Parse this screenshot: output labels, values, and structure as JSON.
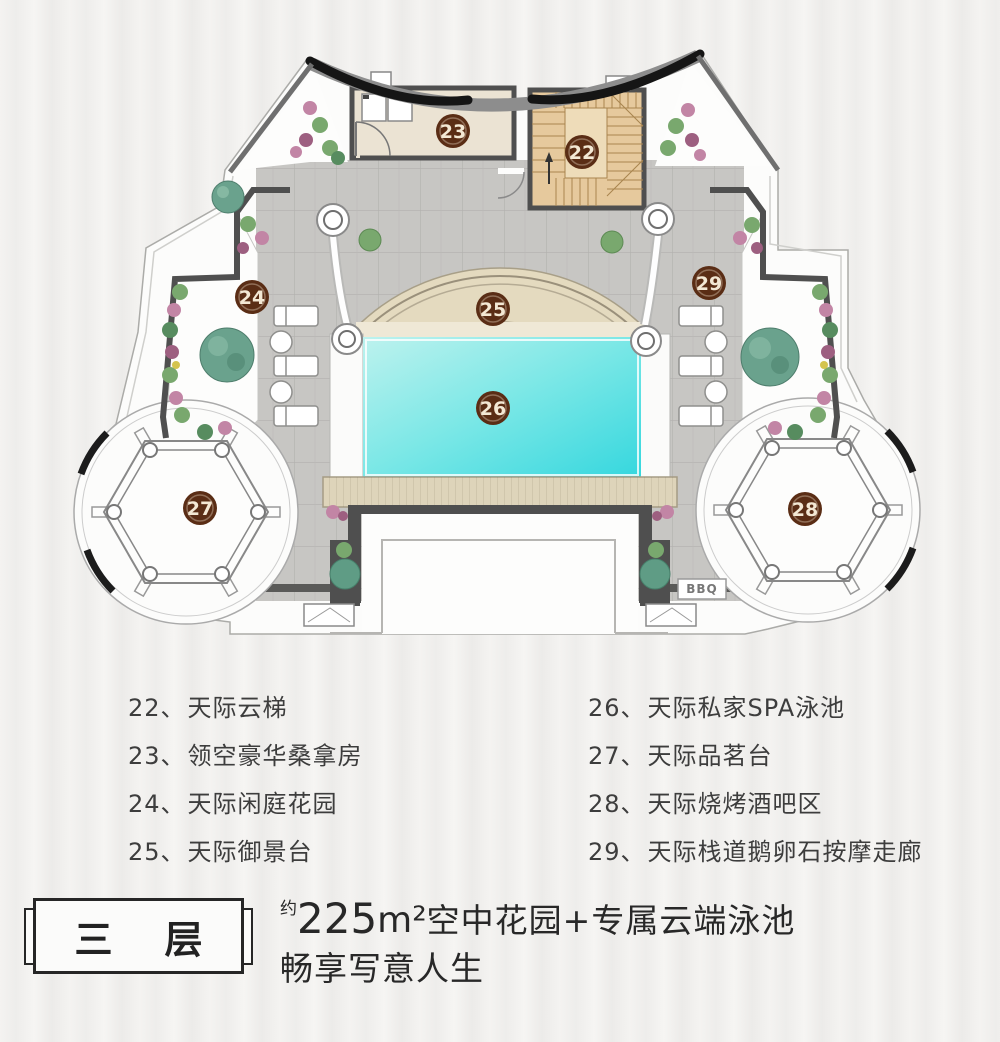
{
  "plan": {
    "markers": [
      {
        "label": "22"
      },
      {
        "label": "23"
      },
      {
        "label": "24"
      },
      {
        "label": "25"
      },
      {
        "label": "26"
      },
      {
        "label": "27"
      },
      {
        "label": "28"
      },
      {
        "label": "29"
      }
    ],
    "bbq": "BBQ"
  },
  "legend": {
    "left": [
      {
        "num": "22、",
        "name": "天际云梯"
      },
      {
        "num": "23、",
        "name": "领空豪华桑拿房"
      },
      {
        "num": "24、",
        "name": "天际闲庭花园"
      },
      {
        "num": "25、",
        "name": "天际御景台"
      }
    ],
    "right": [
      {
        "num": "26、",
        "name": "天际私家SPA泳池"
      },
      {
        "num": "27、",
        "name": "天际品茗台"
      },
      {
        "num": "28、",
        "name": "天际烧烤酒吧区"
      },
      {
        "num": "29、",
        "name": "天际栈道鹅卵石按摩走廊"
      }
    ]
  },
  "footer": {
    "floor_label_1": "三",
    "floor_label_2": "层",
    "approx": "约",
    "area_number": "225",
    "area_unit": "m²",
    "headline_rest": "空中花园+专属云端泳池",
    "headline_line2": "畅享写意人生"
  },
  "colors": {
    "marker": "#5a2d15",
    "wall": "#4f4f4f",
    "paving": "#c7c6c3",
    "deck": "#ded4ba",
    "pool_light": "#bdf2ee",
    "pool_dark": "#35d7de",
    "room_sauna": "#ebe3d3",
    "room_stairs": "#e6c99d",
    "arch_band": "#e4dabf"
  }
}
